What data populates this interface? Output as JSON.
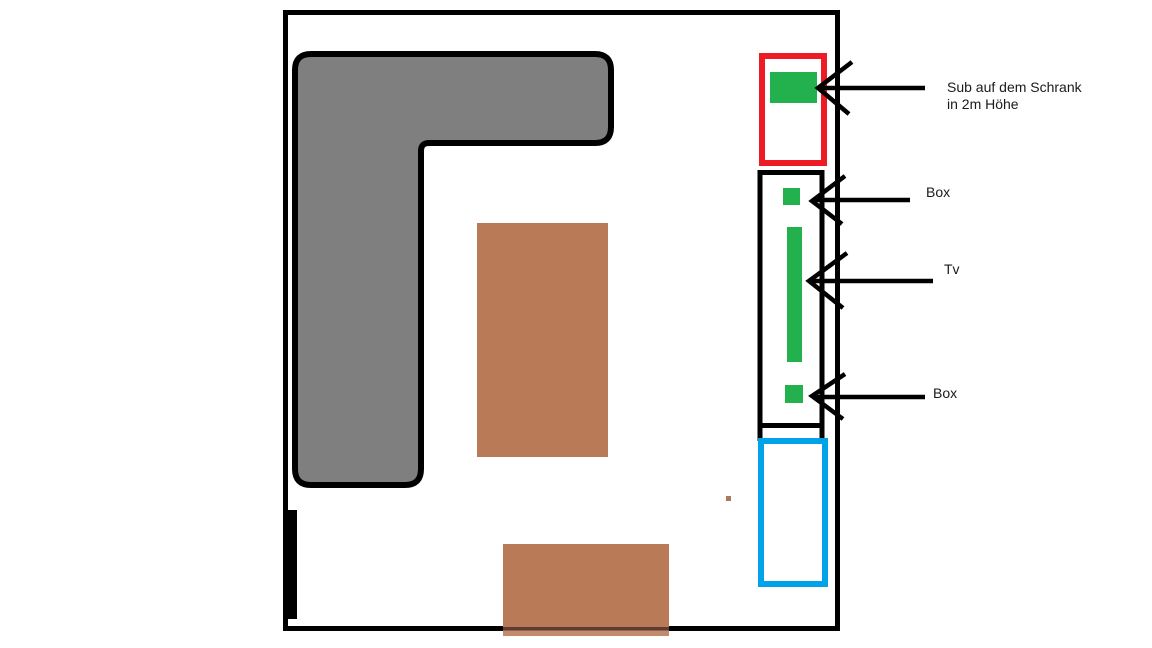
{
  "canvas": {
    "width": 1152,
    "height": 648,
    "background": "#ffffff"
  },
  "colors": {
    "white": "#ffffff",
    "black": "#000000",
    "sofa_gray": "#7f7f7f",
    "furniture_brown": "#b97a57",
    "table_wall_overlap_line": "#5f3c31",
    "table_below_wall_strip": "#c38a6d",
    "small_dot_brown": "#ab7a5e",
    "cabinet_red": "#ed1c24",
    "device_green": "#22b14c",
    "cabinet_blue": "#00a2e8",
    "arrow_black": "#000000",
    "text": "#1a1a1a"
  },
  "annotations": {
    "sub_label_line1": "Sub auf dem Schrank",
    "sub_label_line2": "in 2m Höhe",
    "box_top_label": "Box",
    "tv_label": "Tv",
    "box_bottom_label": "Box"
  }
}
